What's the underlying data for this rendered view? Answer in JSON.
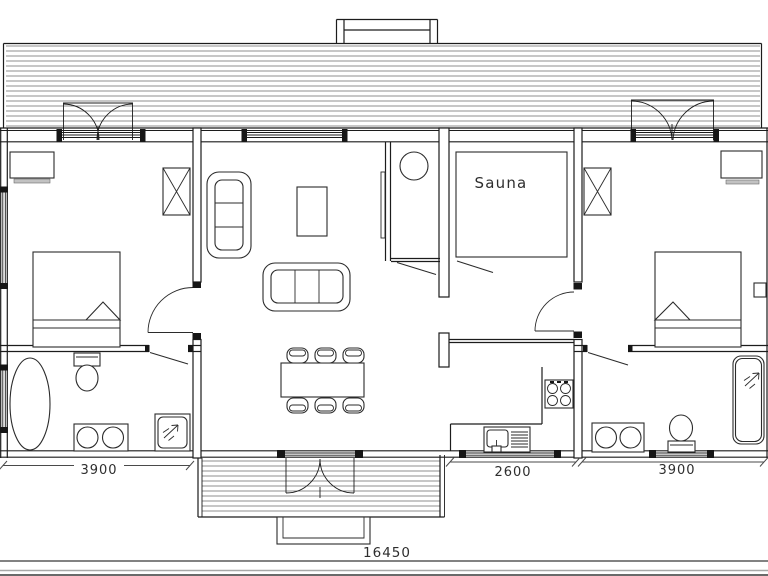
{
  "floor_plan": {
    "room_labels": {
      "sauna": "Sauna"
    },
    "dimensions": {
      "left_section": "3900",
      "entrance_section": "2600",
      "right_section": "3900",
      "total_length": "16450"
    },
    "colors": {
      "line": "#1c1c1c",
      "roof_hatch": "#8f8f8f",
      "dim_text": "#2e2e2e",
      "ground_bar": "#6a6a6a",
      "background": "#ffffff"
    },
    "fixture_icons": [
      "double-bed-icon",
      "corner-sofa-icon",
      "sofa-icon",
      "coffee-table-icon",
      "dining-table-icon",
      "dining-chair-icon",
      "fireplace-flue-icon",
      "sauna-heater-icon",
      "kitchen-stove-icon",
      "kitchen-sink-icon",
      "shower-cabin-icon",
      "shower-spray-icon",
      "oval-bathtub-icon",
      "bathtub-icon",
      "toilet-icon",
      "twin-basin-vanity-icon",
      "wardrobe-icon",
      "nightstand-icon",
      "door-swing-icon",
      "window-icon",
      "casement-window-icon",
      "chimney-icon",
      "porch-deck-icon",
      "step-icon"
    ]
  }
}
